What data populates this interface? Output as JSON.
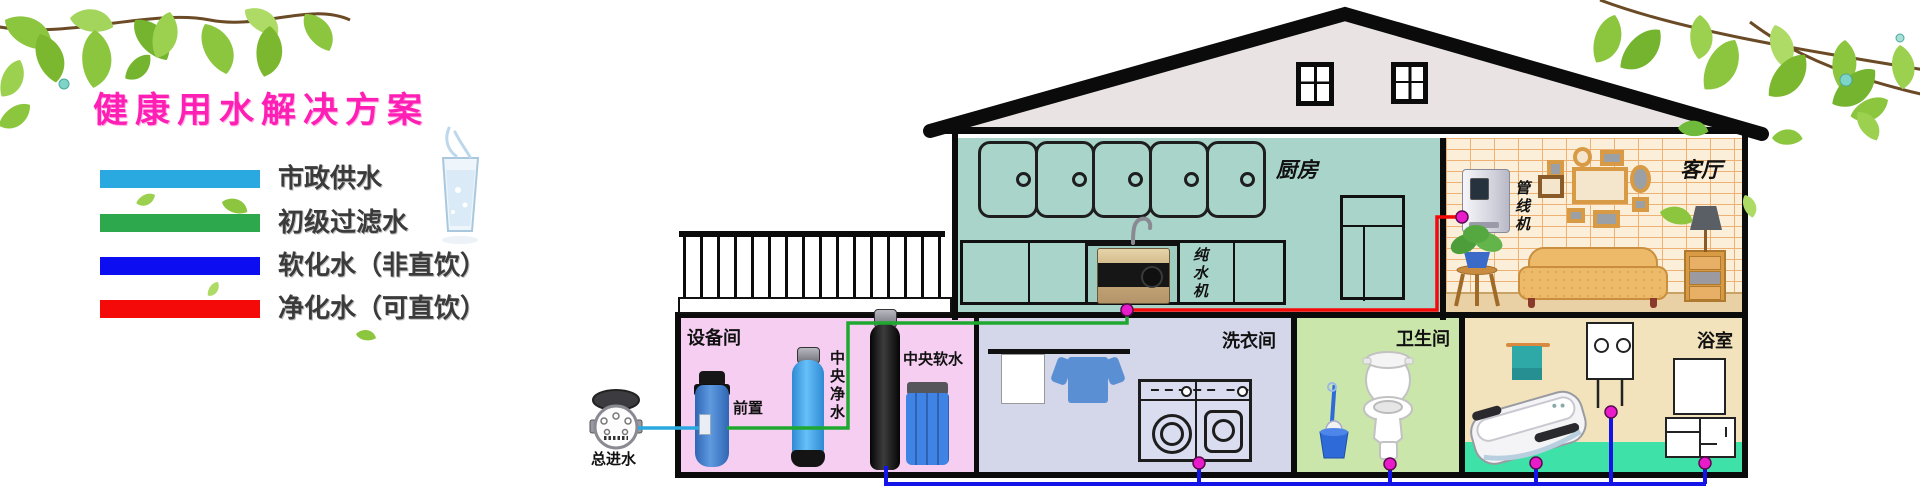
{
  "title": "健康用水解决方案",
  "legend": {
    "items": [
      {
        "label": "市政供水",
        "color": "#29a9e0"
      },
      {
        "label": "初级过滤水",
        "color": "#2ea84c"
      },
      {
        "label": "软化水（非直饮）",
        "color": "#0d0df2"
      },
      {
        "label": "净化水（可直饮）",
        "color": "#f50a0a"
      }
    ]
  },
  "meter": {
    "label": "总进水"
  },
  "rooms": {
    "kitchen": "厨房",
    "living": "客厅",
    "equipment": "设备间",
    "laundry": "洗衣间",
    "toilet": "卫生间",
    "bath": "浴室"
  },
  "devices": {
    "pure_water_machine": "纯水机",
    "pipeline_machine": "管线机",
    "prefilter": "前置",
    "central_purifier": "中央净水",
    "central_softener": "中央软水"
  },
  "pipe_colors": {
    "municipal": "#29a9e0",
    "filtered": "#1fa830",
    "softened": "#1414e8",
    "purified": "#f50a0a",
    "joint_dot": "#e81cc8"
  }
}
